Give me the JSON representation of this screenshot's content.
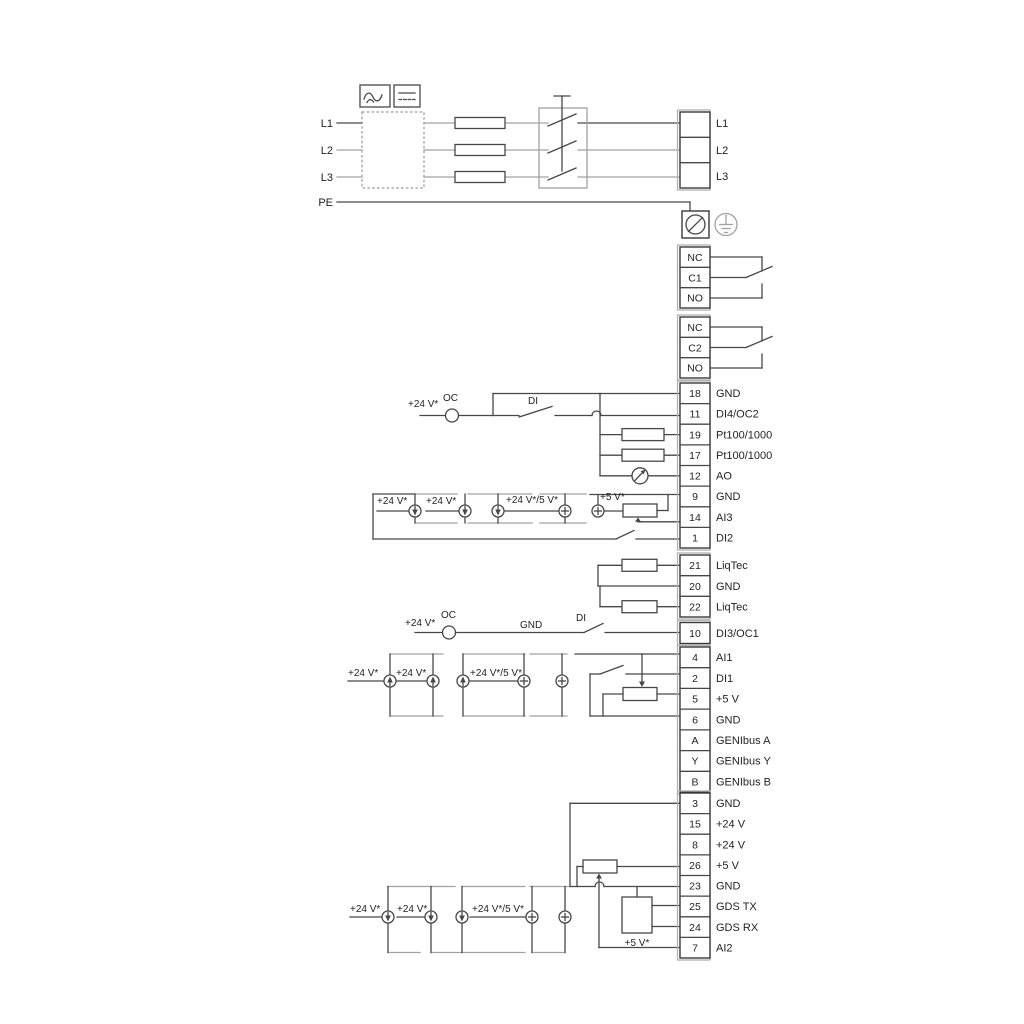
{
  "power": {
    "inputs": [
      "L1",
      "L2",
      "L3",
      "PE"
    ],
    "outputs": [
      "L1",
      "L2",
      "L3"
    ]
  },
  "relays": [
    {
      "cells": [
        "NC",
        "C1",
        "NO"
      ]
    },
    {
      "cells": [
        "NC",
        "C2",
        "NO"
      ]
    }
  ],
  "strip_io": {
    "rows": [
      {
        "num": "18",
        "label": "GND"
      },
      {
        "num": "11",
        "label": "DI4/OC2"
      },
      {
        "num": "19",
        "label": "Pt100/1000"
      },
      {
        "num": "17",
        "label": "Pt100/1000"
      },
      {
        "num": "12",
        "label": "AO"
      },
      {
        "num": "9",
        "label": "GND"
      },
      {
        "num": "14",
        "label": "AI3"
      },
      {
        "num": "1",
        "label": "DI2"
      }
    ]
  },
  "strip_liqtec": {
    "rows": [
      {
        "num": "21",
        "label": "LiqTec"
      },
      {
        "num": "20",
        "label": "GND"
      },
      {
        "num": "22",
        "label": "LiqTec"
      }
    ]
  },
  "term_di3": {
    "num": "10",
    "label": "DI3/OC1"
  },
  "strip_mid": {
    "rows": [
      {
        "num": "4",
        "label": "AI1"
      },
      {
        "num": "2",
        "label": "DI1"
      },
      {
        "num": "5",
        "label": "+5 V"
      },
      {
        "num": "6",
        "label": "GND"
      },
      {
        "num": "A",
        "label": "GENIbus A"
      },
      {
        "num": "Y",
        "label": "GENIbus Y"
      },
      {
        "num": "B",
        "label": "GENIbus B"
      }
    ]
  },
  "strip_bottom": {
    "rows": [
      {
        "num": "3",
        "label": "GND"
      },
      {
        "num": "15",
        "label": "+24 V"
      },
      {
        "num": "8",
        "label": "+24 V"
      },
      {
        "num": "26",
        "label": "+5 V"
      },
      {
        "num": "23",
        "label": "GND"
      },
      {
        "num": "25",
        "label": "GDS TX"
      },
      {
        "num": "24",
        "label": "GDS RX"
      },
      {
        "num": "7",
        "label": "AI2"
      }
    ]
  },
  "ann": {
    "oc2": {
      "v24": "+24 V*",
      "oc": "OC",
      "di": "DI"
    },
    "ai3": {
      "v24a": "+24 V*",
      "v24b": "+24 V*",
      "v24_5": "+24 V*/5 V*",
      "v5": "+5 V*"
    },
    "oc1": {
      "v24": "+24 V*",
      "oc": "OC",
      "gnd": "GND",
      "di": "DI"
    },
    "ai1": {
      "v24a": "+24 V*",
      "v24b": "+24 V*",
      "v24_5": "+24 V*/5 V*"
    },
    "ai2": {
      "v24a": "+24 V*",
      "v24b": "+24 V*",
      "v24_5": "+24 V*/5 V*",
      "v5": "+5 V*"
    }
  }
}
